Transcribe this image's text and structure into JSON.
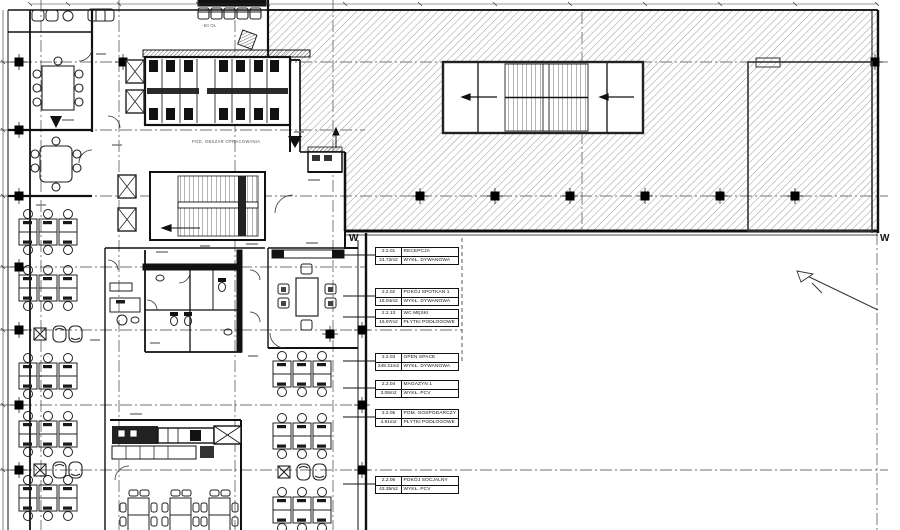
{
  "markers": {
    "w_left": "W",
    "w_right": "W"
  },
  "notes": {
    "scope": "POD. OBSZAR OPRACOWANIA",
    "level": "-50 OL"
  },
  "schedule": {
    "rooms": [
      {
        "number": "2.2.01",
        "name": "RECEPCJA",
        "area": "24.72m2",
        "floor": "WYKŁ. DYWANOWA"
      },
      {
        "number": "2.2.02",
        "name": "POKÓJ SPOTKAŃ 1",
        "area": "16.04m2",
        "floor": "WYKŁ. DYWANOWA"
      },
      {
        "number": "2.2.13",
        "name": "WC MĘSKI",
        "area": "16.07m2",
        "floor": "PŁYTKI PODŁOGOWE"
      },
      {
        "number": "2.2.03",
        "name": "OPEN SPACE",
        "area": "249.31m2",
        "floor": "WYKŁ. DYWANOWA"
      },
      {
        "number": "2.2.04",
        "name": "MAGAZYN 1",
        "area": "3.08m2",
        "floor": "WYKŁ. PCV"
      },
      {
        "number": "2.2.05",
        "name": "POM. GOSPODARCZY",
        "area": "4.91m2",
        "floor": "PŁYTKI PODŁOGOWE"
      },
      {
        "number": "2.2.06",
        "name": "POKÓJ SOCJALNY",
        "area": "43.35m2",
        "floor": "WYKŁ. PCV"
      }
    ]
  },
  "colors": {
    "wall": "#111111",
    "hatch_line": "#9a9a9a",
    "grid_line": "#444444",
    "background": "#ffffff"
  }
}
